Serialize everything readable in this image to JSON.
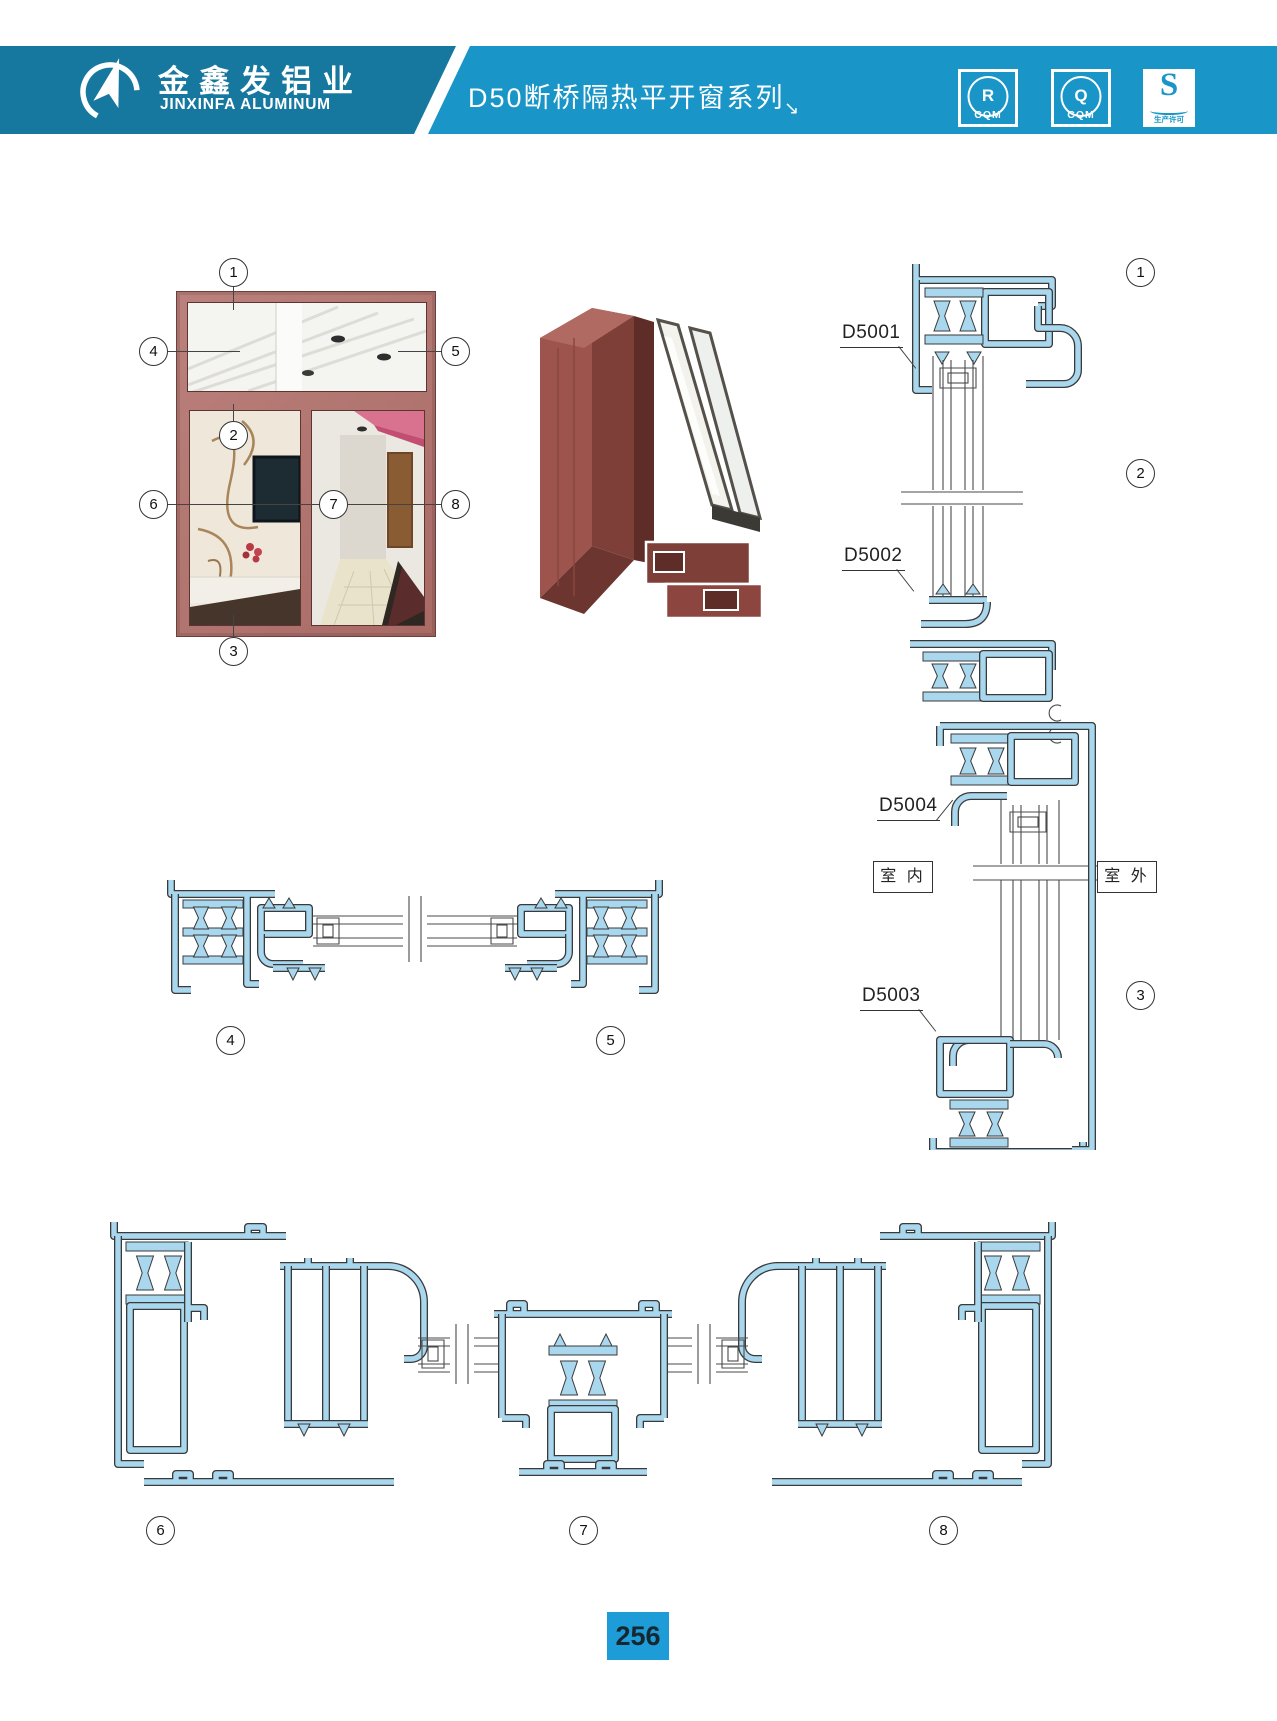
{
  "header": {
    "brand_cn": "金鑫发铝业",
    "brand_en": "JINXINFA ALUMINUM",
    "series_title": "D50断桥隔热平开窗系列",
    "arrow_glyph": "↘",
    "badges": [
      {
        "symbol": "R",
        "caption": "CQM"
      },
      {
        "symbol": "Q",
        "caption": "CQM"
      },
      {
        "symbol": "S",
        "caption": "生产许可"
      }
    ],
    "colors": {
      "band_left": "#17789F",
      "band_right": "#1995C7"
    }
  },
  "callouts": {
    "n1": "1",
    "n2": "2",
    "n3": "3",
    "n4": "4",
    "n5": "5",
    "n6": "6",
    "n7": "7",
    "n8": "8"
  },
  "profile_labels": {
    "d5001": "D5001",
    "d5002": "D5002",
    "d5003": "D5003",
    "d5004": "D5004"
  },
  "side_labels": {
    "indoor": "室 内",
    "outdoor": "室 外"
  },
  "figure_colors": {
    "frame_rosewood": "#B2736E",
    "profile_blue": "#A9D7EE",
    "drawing_outline": "#3A3A3A"
  },
  "footer": {
    "page_number": "256",
    "box_color": "#1E9CD8"
  }
}
